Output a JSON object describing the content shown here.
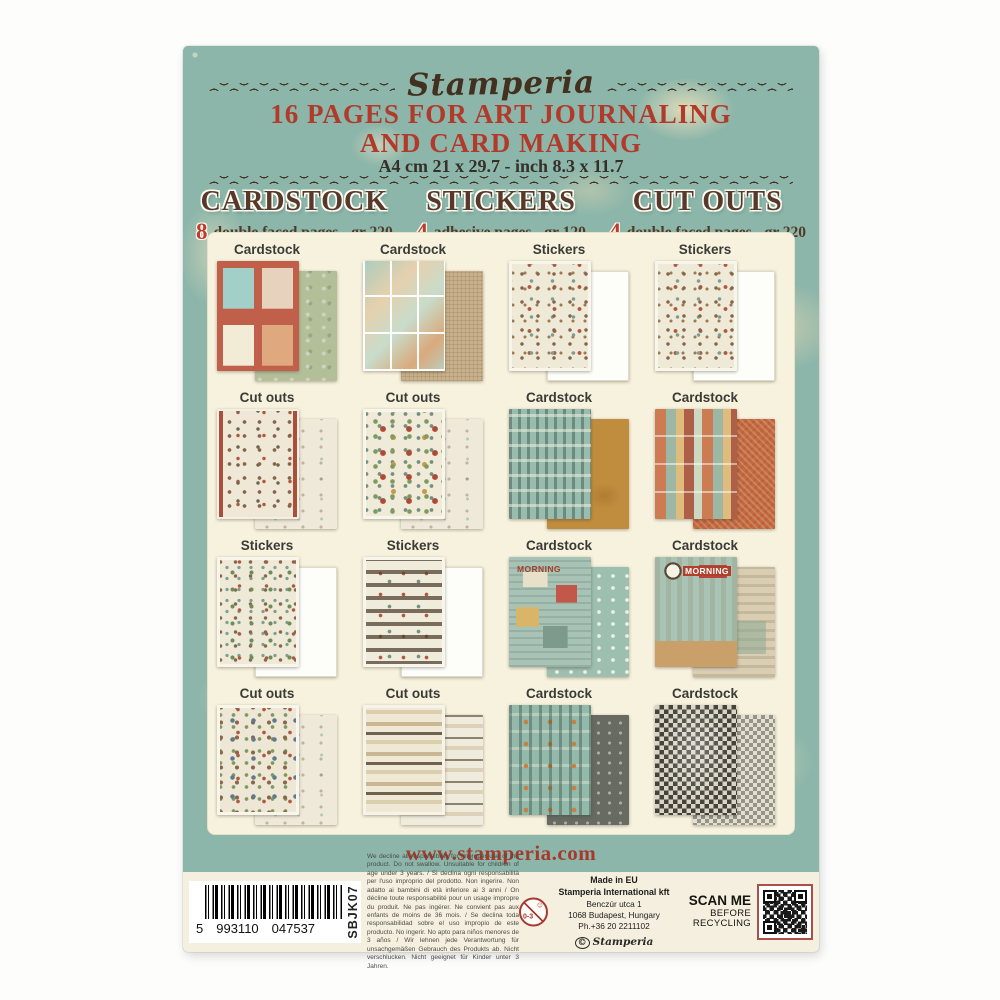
{
  "card": {
    "brand": "Stamperia",
    "title_line1": "16 PAGES FOR ART JOURNALING",
    "title_line2": "AND CARD MAKING",
    "size_line": "A4 cm 21 x 29.7 - inch 8.3 x 11.7",
    "specs": [
      {
        "name": "CARDSTOCK",
        "count": "8",
        "desc": "double faced pages - gr 220"
      },
      {
        "name": "STICKERS",
        "count": "4",
        "desc": "adhesive pages - gr 120"
      },
      {
        "name": "CUT OUTS",
        "count": "4",
        "desc": "double faced pages - gr 220"
      }
    ],
    "grid": {
      "cells": [
        {
          "label": "Cardstock"
        },
        {
          "label": "Cardstock"
        },
        {
          "label": "Stickers"
        },
        {
          "label": "Stickers"
        },
        {
          "label": "Cut outs"
        },
        {
          "label": "Cut outs"
        },
        {
          "label": "Cardstock"
        },
        {
          "label": "Cardstock"
        },
        {
          "label": "Stickers"
        },
        {
          "label": "Stickers"
        },
        {
          "label": "Cardstock",
          "overlay": "MORNING"
        },
        {
          "label": "Cardstock",
          "overlay": "MORNING"
        },
        {
          "label": "Cut outs"
        },
        {
          "label": "Cut outs"
        },
        {
          "label": "Cardstock"
        },
        {
          "label": "Cardstock"
        }
      ]
    },
    "website": "www.stamperia.com",
    "footer": {
      "barcode": {
        "lead": "5",
        "group1": "993110",
        "group2": "047537",
        "sku": "SBJK07"
      },
      "disclaimer": "We decline all responsibility for improper use of the product. Do not swallow. Unsuitable for children of age under 3 years. / Si declina ogni responsabilità per l'uso improprio del prodotto. Non ingerire. Non adatto ai bambini di età inferiore ai 3 anni / On décline toute responsabilité pour un usage impropre du produit. Ne pas ingérer. Ne convient pas aux enfants de moins de 36 mois. / Se declina toda responsabilidad sobre el uso impropio de este producto. No ingerir. No apto para niños menores de 3 años / Wir lehnen jede Verantwortung für unsachgemäßen Gebrauch des Produkts ab. Nicht verschlucken. Nicht geeignet für Kinder unter 3 Jahren.",
      "age_label": "0-3",
      "made_in": {
        "l1": "Made in EU",
        "l2": "Stamperia International kft",
        "l3": "Benczúr utca 1",
        "l4": "1068 Budapest, Hungary",
        "l5": "Ph.+36 20 2211102",
        "copyright_mark": "©",
        "copyright_name": "Stamperia"
      },
      "scan": {
        "l1": "SCAN ME",
        "l2": "BEFORE",
        "l3": "RECYCLING"
      }
    },
    "colors": {
      "teal": "#8cb6aa",
      "cream": "#f7f2de",
      "red": "#b23a2b",
      "brown": "#57382a"
    }
  }
}
